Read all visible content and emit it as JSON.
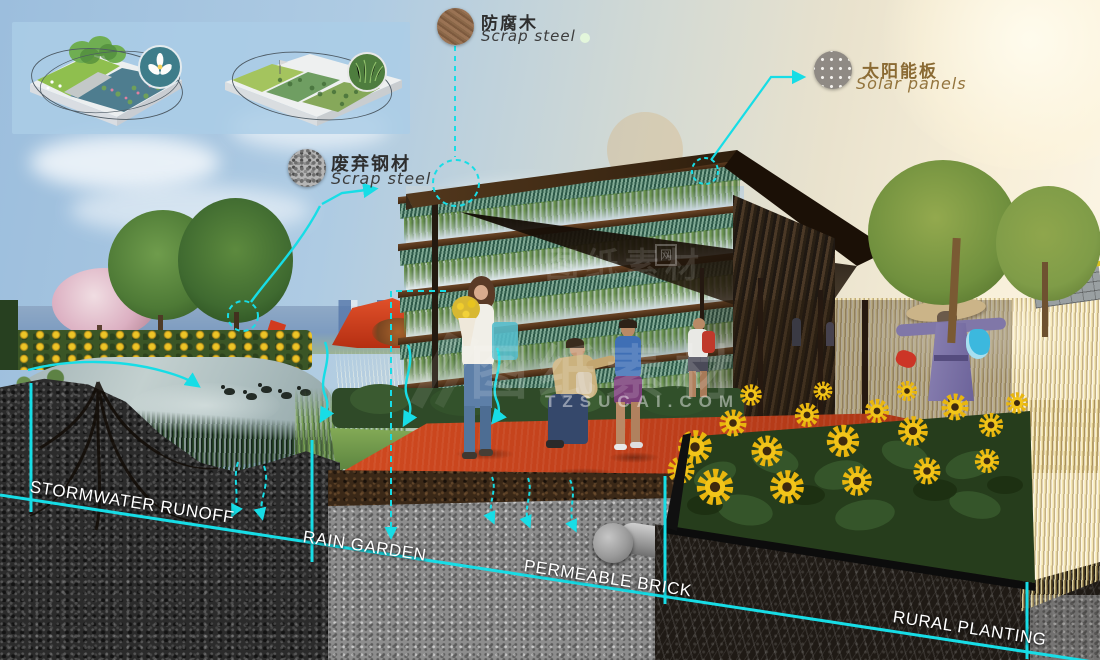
{
  "material_callouts": [
    {
      "id": "anticorrosive-wood",
      "label_zh": "防腐木",
      "label_en": "Scrap steel"
    },
    {
      "id": "scrap-steel",
      "label_zh": "废弃钢材",
      "label_en": "Scrap steel"
    },
    {
      "id": "solar-panels",
      "label_zh": "太阳能板",
      "label_en": "Solar panels"
    }
  ],
  "section_labels": [
    {
      "id": "stormwater-runoff",
      "text": "STORMWATER RUNOFF"
    },
    {
      "id": "rain-garden",
      "text": "RAIN GARDEN"
    },
    {
      "id": "permeable-brick",
      "text": "PERMEABLE BRICK"
    },
    {
      "id": "rural-planting",
      "text": "RURAL PLANTING"
    }
  ],
  "watermark": {
    "cn_large": "图纸素材",
    "cn_small": "网",
    "site": "TZSUCAI.COM"
  },
  "colors": {
    "annotation_cyan": "#17dde6",
    "plaza_red": "#c84523",
    "label_white": "#ffffff"
  }
}
